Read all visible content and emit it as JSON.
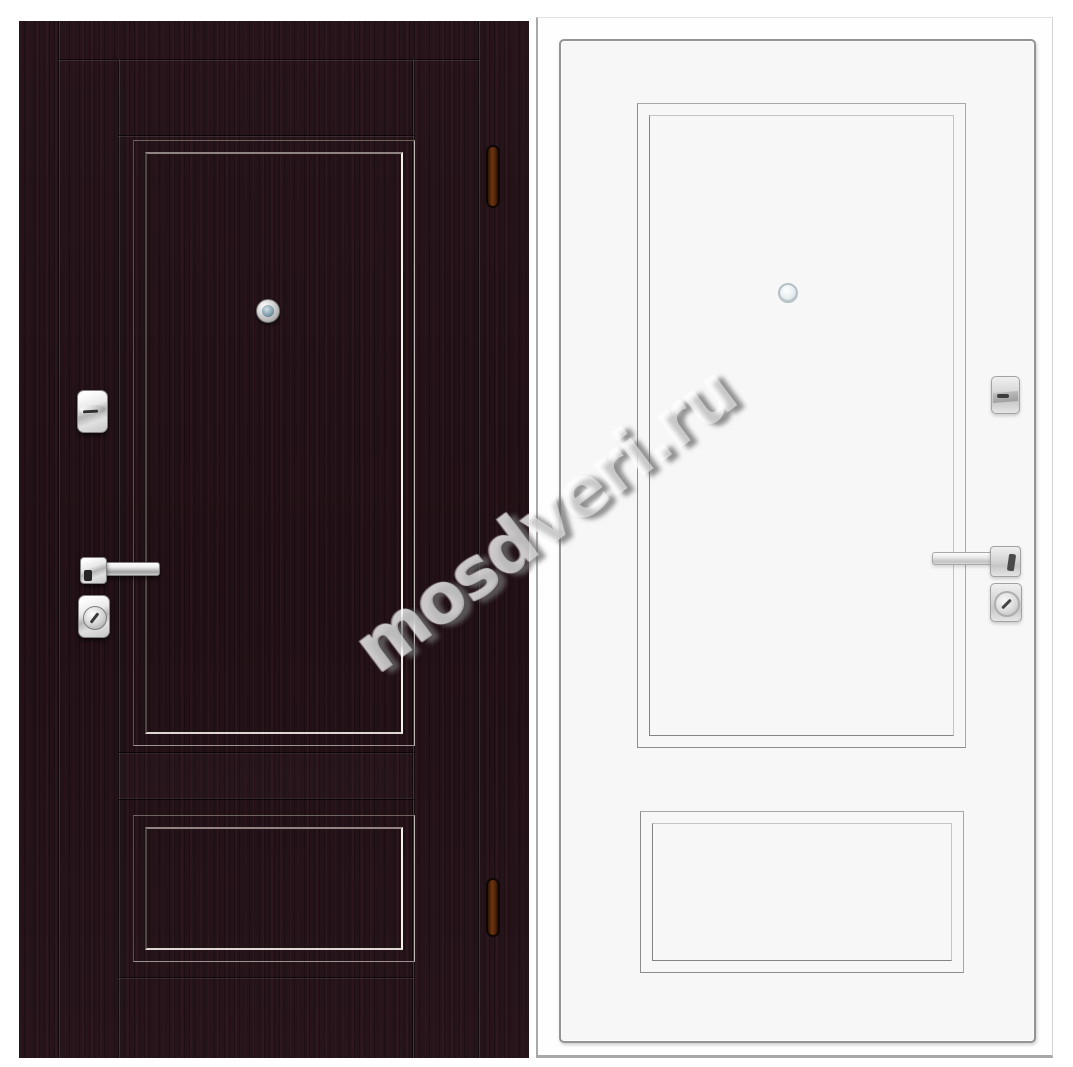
{
  "watermark": {
    "text": "mosdveri.ru"
  },
  "colors": {
    "page-bg": "#ffffff",
    "wenge-base": "#231117",
    "wenge-dark": "#1d0d12",
    "white-door-face": "#f7f7f7",
    "chrome-hi": "#fdfdfd",
    "hinge-amber": "#6e3410",
    "lens-blue": "#7d99a8",
    "watermark-fill": "rgba(255,255,255,0.5)",
    "watermark-shadow": "rgba(110,110,110,0.75)"
  },
  "doors": {
    "left": {
      "view": "front",
      "finish": "dark wenge",
      "parts": [
        "peephole",
        "keyhole-escutcheon",
        "lever-handle",
        "cylinder-lock",
        "hinge",
        "hinge"
      ]
    },
    "right": {
      "view": "back",
      "finish": "white",
      "parts": [
        "peephole",
        "thumbturn-lock",
        "lever-handle",
        "cylinder-lock"
      ]
    }
  }
}
